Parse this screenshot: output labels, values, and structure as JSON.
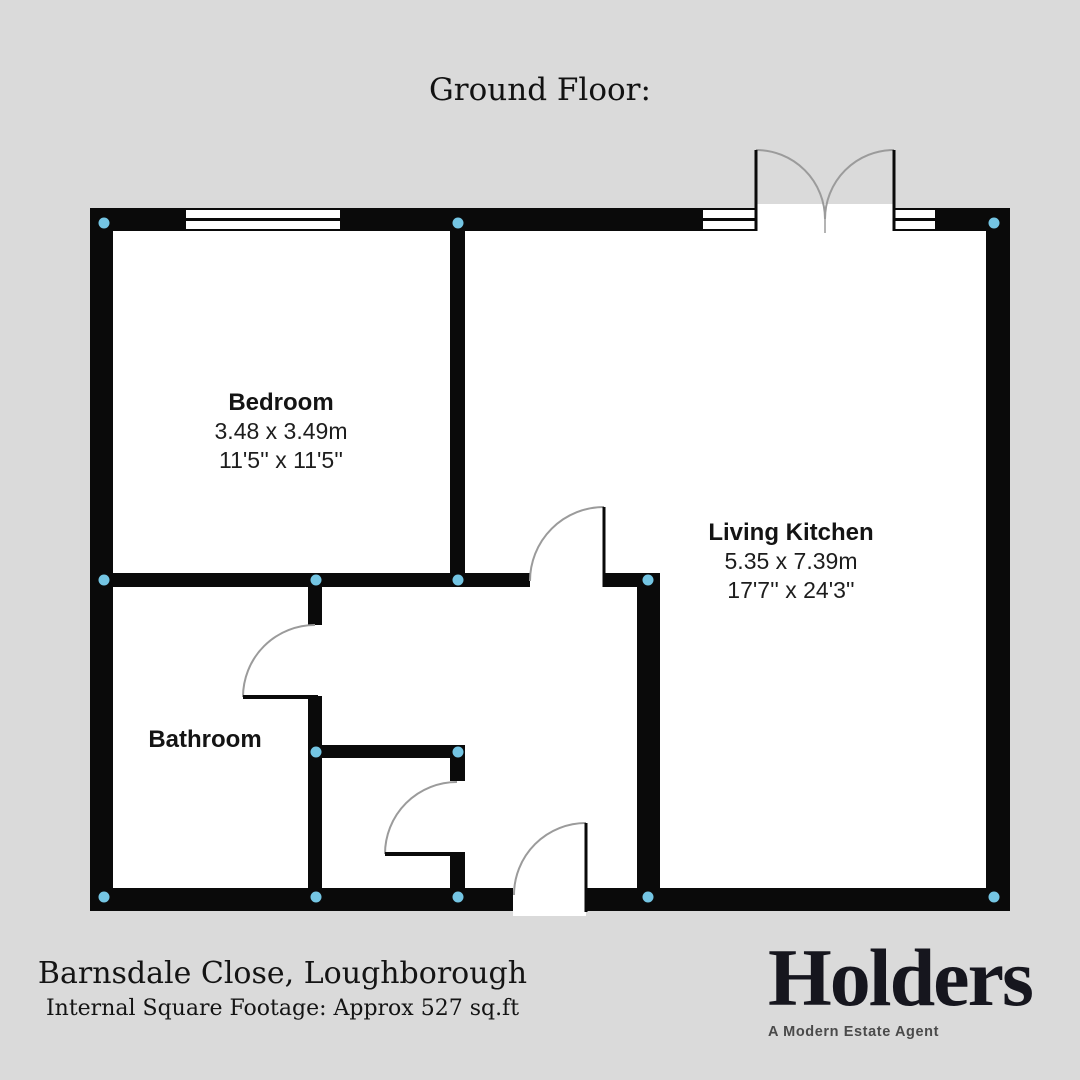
{
  "title": "Ground Floor:",
  "rooms": [
    {
      "name": "Bedroom",
      "metric": "3.48 x 3.49m",
      "imperial": "11'5'' x 11'5''"
    },
    {
      "name": "Living Kitchen",
      "metric": "5.35 x 7.39m",
      "imperial": "17'7'' x 24'3''"
    },
    {
      "name": "Bathroom"
    }
  ],
  "footer": {
    "address": "Barnsdale Close, Loughborough",
    "square_footage": "Internal Square Footage: Approx 527 sq.ft"
  },
  "brand": {
    "name": "Holders",
    "tagline": "A Modern Estate Agent"
  },
  "colors": {
    "background": "#dadada",
    "wall": "#0a0a0a",
    "interior": "#ffffff",
    "junction_marker": "#74c5e3",
    "door_arc": "#9b9b9b",
    "logo": "#16161e"
  }
}
